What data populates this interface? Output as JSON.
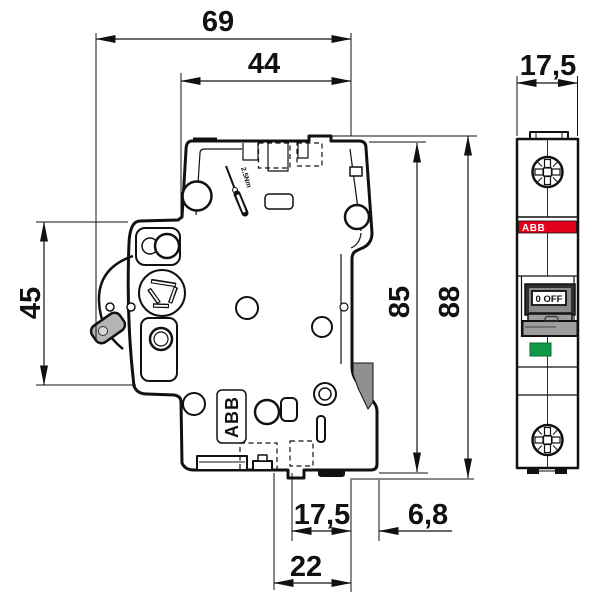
{
  "side_view": {
    "dim_total_depth": "69",
    "dim_body_depth": "44",
    "dim_front_height": "45",
    "dim_body_height": "85",
    "dim_total_height": "88",
    "dim_rail_width": "17,5",
    "dim_rail_offset": "6,8",
    "dim_clip_span": "22",
    "torque_label": "2.5Nm",
    "brand_label": "ABB"
  },
  "front_view": {
    "dim_width": "17,5",
    "brand_label": "ABB",
    "switch_label": "0 OFF"
  },
  "colors": {
    "line": "#111111",
    "brand_red": "#e2001a",
    "indicator_green": "#109a46",
    "handle_gray": "#9e9e9e",
    "toggle_gray": "#b5b5b5",
    "clip_gray": "#909090",
    "frame_dark": "#2e2e2e",
    "frame_inner_gray": "#8a8a8a"
  }
}
